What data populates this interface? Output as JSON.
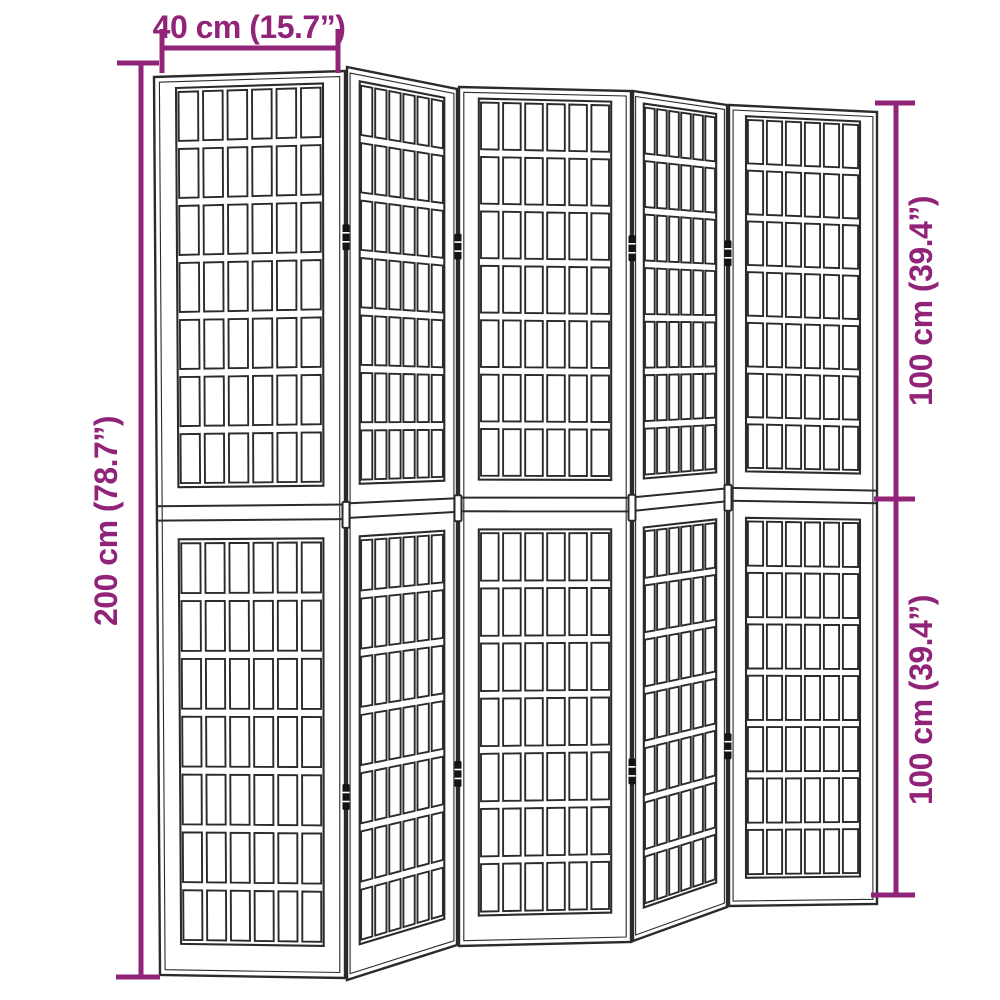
{
  "diagram": {
    "title": "Folding room divider dimension diagram",
    "panel_count": 5,
    "sections_per_panel": 2,
    "grid_columns": 6,
    "grid_rows_per_section": 7,
    "hinge_joints": 4,
    "hinges_per_joint": 3
  },
  "dimensions": {
    "panel_width": "40 cm (15.7”)",
    "total_height": "200 cm (78.7”)",
    "upper_section_height": "100 cm (39.4”)",
    "lower_section_height": "100 cm (39.4”)"
  },
  "colors": {
    "accent": "#912478",
    "outline": "#2B2B2B",
    "background": "#FFFFFF"
  }
}
